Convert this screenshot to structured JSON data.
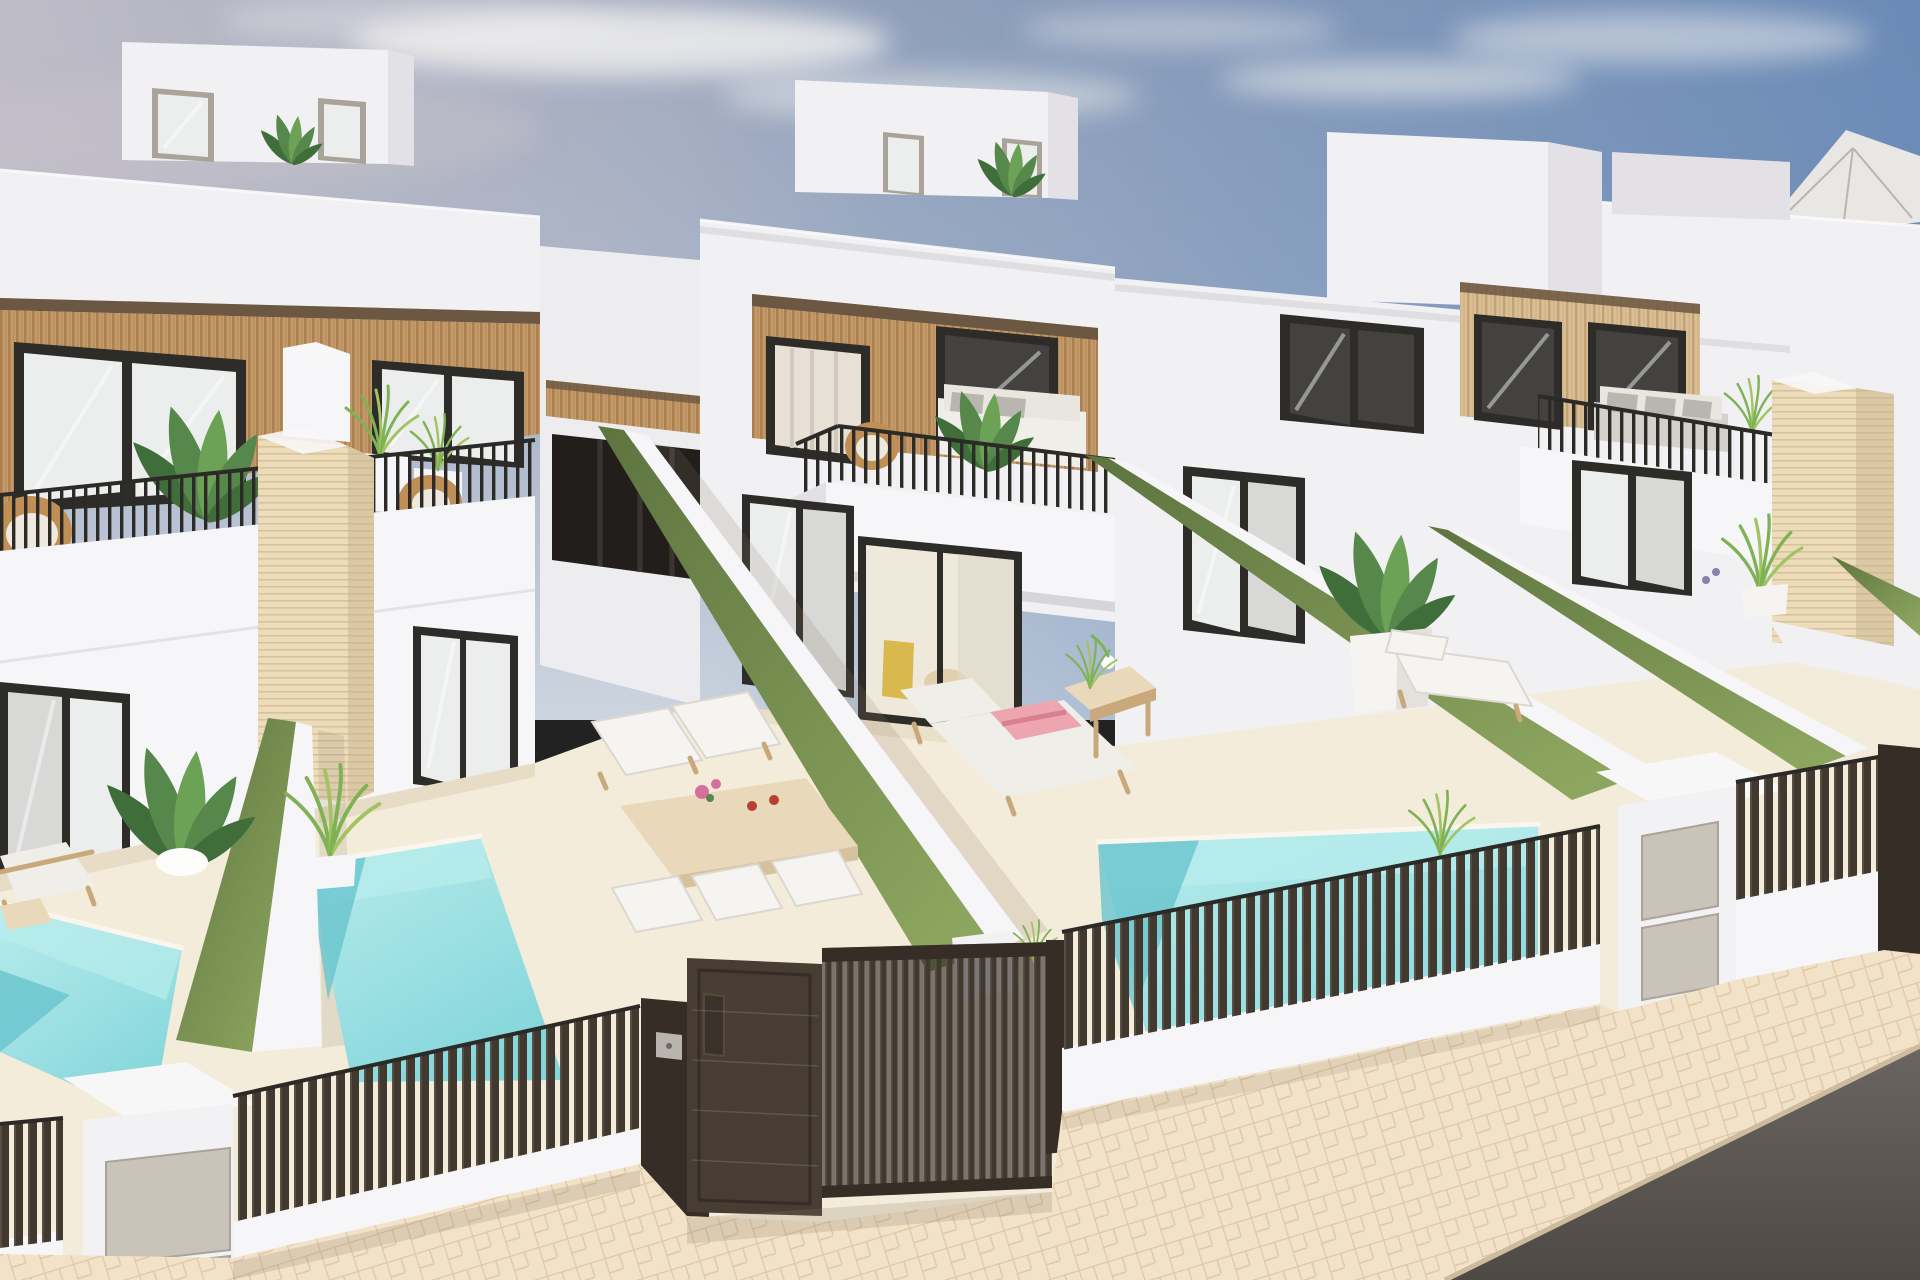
{
  "meta": {
    "kind": "3d-architectural-render",
    "label": "Row of new-build modern white two-storey villas with wooden facade cladding, roof terraces, green privacy walls, private plunge pools, dark slatted street fences and gates, herringbone sidewalk and asphalt road corner under a partly cloudy blue sky",
    "width_px": 1920,
    "height_px": 1280
  },
  "scene": {
    "houses_visible": 4,
    "roof_boxes": 3,
    "pools_visible": 3,
    "green_privacy_walls": 5,
    "travertine_pillars": 3,
    "street_side": {
      "fence_style": "dark brown vertical slats",
      "gates": [
        "solid pedestrian door with mail slot and keypad",
        "slatted sliding vehicle gate"
      ],
      "utility_posts_with_meter_doors": 3,
      "sidewalk": "beige herringbone paving",
      "road": "dark asphalt, bottom-right corner"
    },
    "furniture": [
      "rattan lounge chairs",
      "white balcony sofa",
      "grey balcony sofa",
      "sun lounger with pink towel",
      "wooden side table",
      "outdoor dining table with white chairs",
      "two sun loungers",
      "roof parasol"
    ],
    "planting": [
      "banana plants in pots",
      "ornamental grasses",
      "white cube planters",
      "potted palm"
    ]
  },
  "palette": {
    "sky_top": "#98a4bc",
    "sky_mid": "#aab6ca",
    "sky_low": "#ccd4df",
    "sky_blue": "#5b82b4",
    "haze": "#c8c2c9",
    "cloud": "#f4f2f0",
    "wall_bright": "#f6f5f7",
    "wall_std": "#f1f0f2",
    "wall_shade": "#e3e1e5",
    "cornice_shadow": "#d7d5d9",
    "soffit": "#6b5742",
    "wood_base": "#c49a6b",
    "wood_stripe": "#ab8150",
    "woodl_base": "#dabf96",
    "woodl_stripe": "#c3a274",
    "frame_dark": "#2e2c29",
    "glass_light": "#eceeee",
    "glass_mid": "#d8d9d7",
    "glass_dark": "#434240",
    "curtain": "#e6e0d5",
    "glass_streak": "#ffffff",
    "railing": "#2c2a27",
    "trav": "#ecdcba",
    "trav_line": "#d8c29b",
    "trav_shade": "#c7b28c",
    "green_light": "#8da65f",
    "green_dark": "#5e7440",
    "pool_light": "#b9ecec",
    "pool_mid": "#84d6db",
    "pool_dark": "#69c4cd",
    "coping": "#faf6ee",
    "floor_cream": "#f4ecda",
    "floor_shadow": "#ddd0b4",
    "fence_slat": "#41382f",
    "fence_slat_hi": "#584d41",
    "fence_dark": "#352d26",
    "gate_panel": "#473d32",
    "gate_void": "#17120e",
    "keypad": "#b9b4ad",
    "post_white": "#f2f1f3",
    "post_cap": "#f8f7f8",
    "metal_panel": "#cac3b9",
    "metal_edge": "#aaa399",
    "pave": "#f2e2c8",
    "pave_line": "#ddc3a2",
    "curb": "#cdbb9e",
    "road_a": "#6a6560",
    "road_b": "#4e4944",
    "plant_dark": "#3f6e3b",
    "plant_mid": "#55884a",
    "plant_light": "#6ca256",
    "grass": "#7fb254",
    "grass_y": "#a3c364",
    "rattan": "#c08f55",
    "cushion": "#eee9df",
    "sofa_white": "#f0eee9",
    "sofa_back": "#e9e6e0",
    "sofa_grey": "#d4d1cc",
    "pillow": "#b9b6b0",
    "towel": "#eda6b0",
    "towel_stripe": "#d87f90",
    "flower": "#d66f9e",
    "cup": "#b5402e",
    "tabletop": "#e9d8b9",
    "table_side": "#d5c29d",
    "chair": "#f6f4f0",
    "chair_edge": "#dcd8d1",
    "lounger_wood": "#c9a87b",
    "parasol": "#e9e7e3",
    "parasol_frame": "#4a4642",
    "parasol_rib": "#b9b5b0",
    "lounge_dark": "#666d76",
    "shadow_warm": "#8a7a64"
  }
}
